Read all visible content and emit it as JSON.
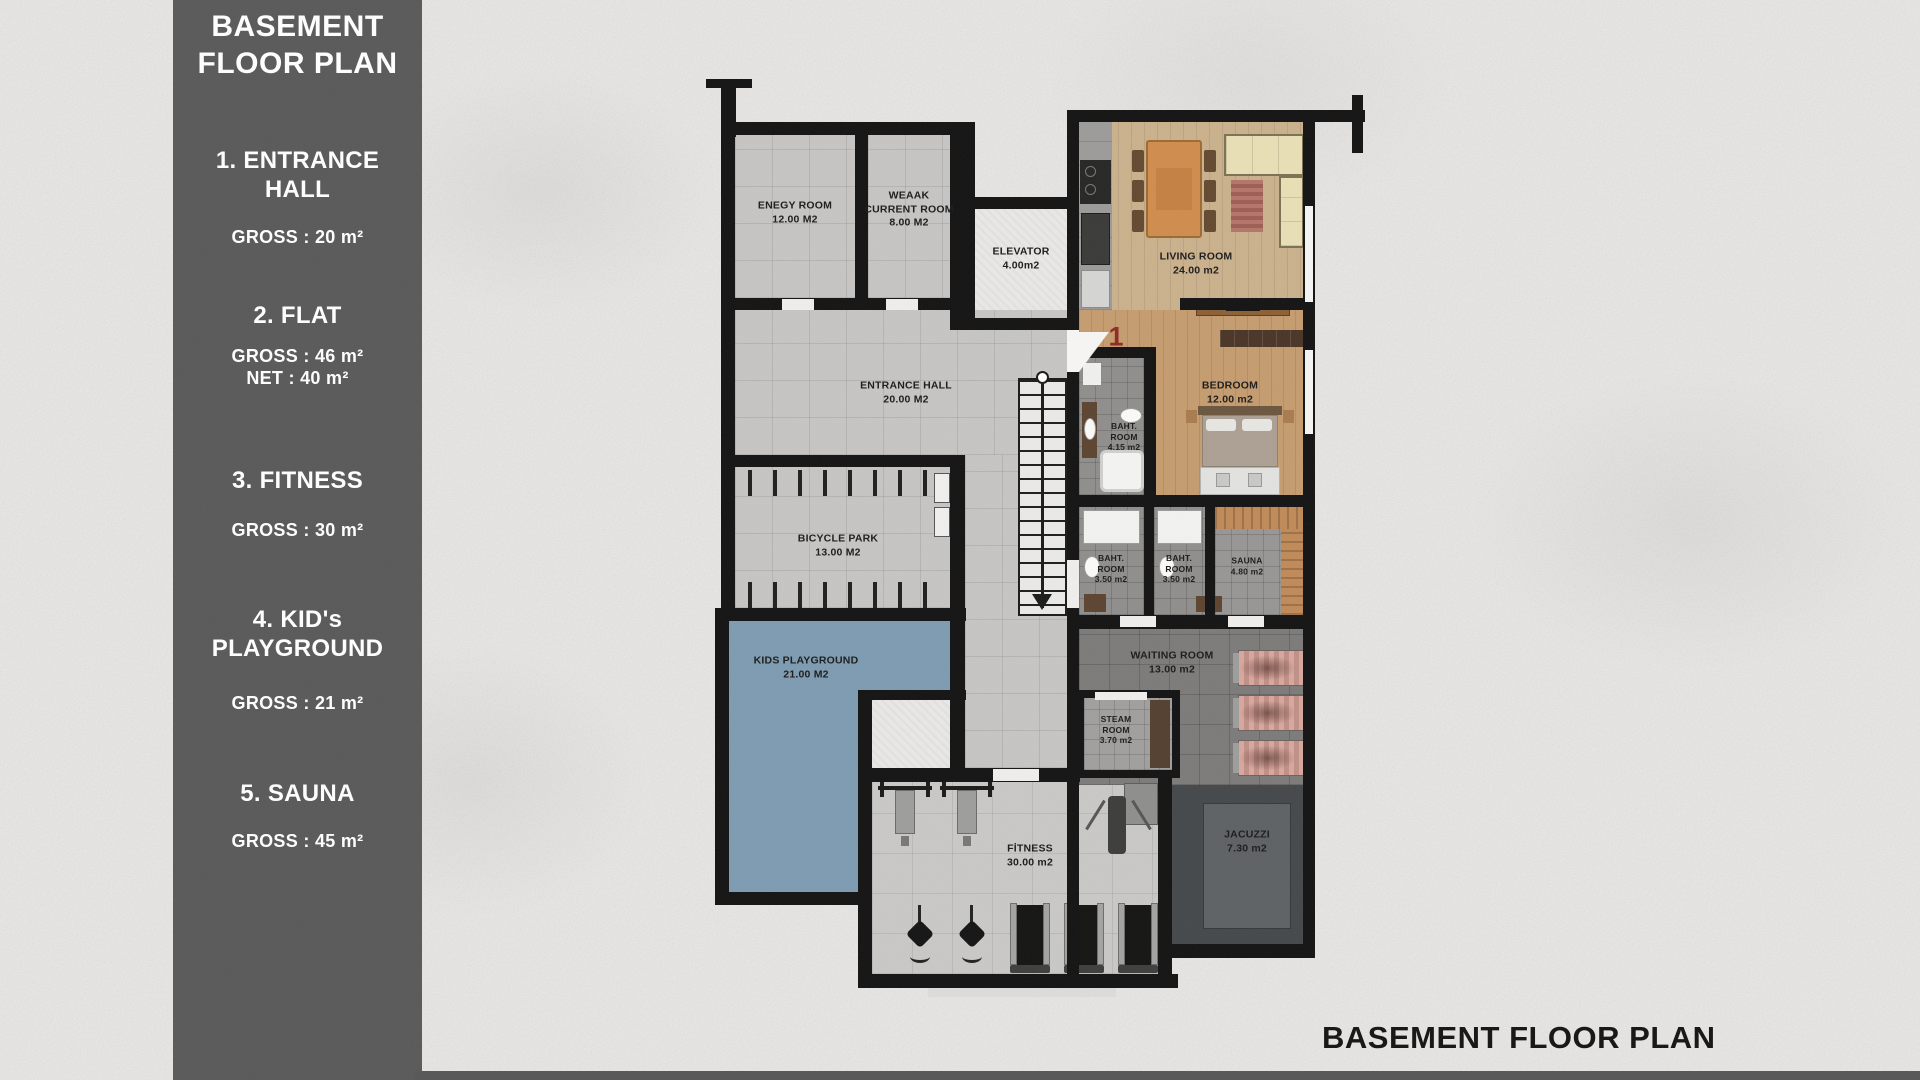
{
  "sidebar": {
    "title": "BASEMENT\nFLOOR PLAN",
    "items": [
      {
        "name": "1. ENTRANCE HALL",
        "details": [
          "GROSS : 20 m²"
        ]
      },
      {
        "name": "2. FLAT",
        "details": [
          "GROSS : 46 m²",
          "NET : 40 m²"
        ]
      },
      {
        "name": "3. FITNESS",
        "details": [
          "GROSS : 30 m²"
        ]
      },
      {
        "name": "4. KID's PLAYGROUND",
        "details": [
          "GROSS : 21 m²"
        ]
      },
      {
        "name": "5. SAUNA",
        "details": [
          "GROSS : 45 m²"
        ]
      }
    ]
  },
  "plan": {
    "flat_number": "1",
    "rooms": {
      "energy": {
        "label": "ENEGY ROOM",
        "area": "12.00 M2"
      },
      "weak_current": {
        "label": "WEAAK CURRENT ROOM",
        "area": "8.00 M2"
      },
      "elevator": {
        "label": "ELEVATOR",
        "area": "4.00m2"
      },
      "living": {
        "label": "LIVING ROOM",
        "area": "24.00 m2"
      },
      "entrance": {
        "label": "ENTRANCE HALL",
        "area": "20.00 M2"
      },
      "bedroom": {
        "label": "BEDROOM",
        "area": "12.00 m2"
      },
      "bath1": {
        "label": "BAHT. ROOM",
        "area": "4.15 m2"
      },
      "bicycle": {
        "label": "BICYCLE PARK",
        "area": "13.00 M2"
      },
      "bath2": {
        "label": "BAHT. ROOM",
        "area": "3.50 m2"
      },
      "bath3": {
        "label": "BAHT. ROOM",
        "area": "3.50 m2"
      },
      "sauna": {
        "label": "SAUNA",
        "area": "4.80 m2"
      },
      "kids": {
        "label": "KIDS PLAYGROUND",
        "area": "21.00 M2"
      },
      "waiting": {
        "label": "WAITING ROOM",
        "area": "13.00 m2"
      },
      "steam": {
        "label": "STEAM ROOM",
        "area": "3.70 m2"
      },
      "fitness": {
        "label": "FİTNESS",
        "area": "30.00 m2"
      },
      "jacuzzi": {
        "label": "JACUZZI",
        "area": "7.30 m2"
      }
    }
  },
  "footer": {
    "title": "BASEMENT FLOOR PLAN"
  },
  "colors": {
    "sidebar_bg": "#595959",
    "wall": "#131313",
    "playground_blue": "#7d9bb1",
    "flat_number_red": "#8e2b20",
    "living_wood": "#cbb18c",
    "bedroom_wood": "#c59c6f",
    "waiting_tile": "#7c7b79",
    "jacuzzi_dark": "#44484a",
    "jacuzzi_inner": "#5d6163",
    "sauna_wood": "#c08a58",
    "background": "#ebe9e7"
  }
}
